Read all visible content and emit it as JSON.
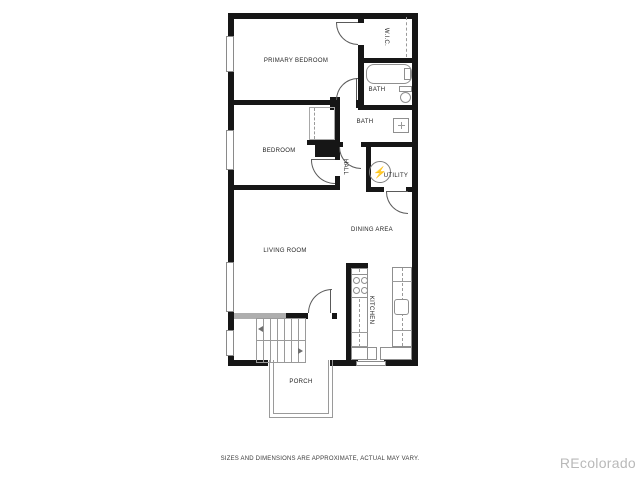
{
  "rooms": {
    "primary_bedroom": "PRIMARY BEDROOM",
    "wic": "W.I.C.",
    "bath_ensuite": "BATH",
    "bath_main": "BATH",
    "bedroom": "BEDROOM",
    "hall": "HALL",
    "utility": "UTILITY",
    "dining": "DINING AREA",
    "living": "LIVING ROOM",
    "kitchen": "KITCHEN",
    "porch": "PORCH"
  },
  "icons": {
    "water_heater": "⚡"
  },
  "footer": {
    "disclaimer": "SIZES AND DIMENSIONS ARE APPROXIMATE, ACTUAL MAY VARY."
  },
  "watermark": {
    "text": "REcolorado"
  },
  "colors": {
    "wall": "#161616",
    "fixture_line": "#8f8f8f",
    "label_text": "#1f1f1f",
    "watermark_gray": "#b9b9b9"
  }
}
